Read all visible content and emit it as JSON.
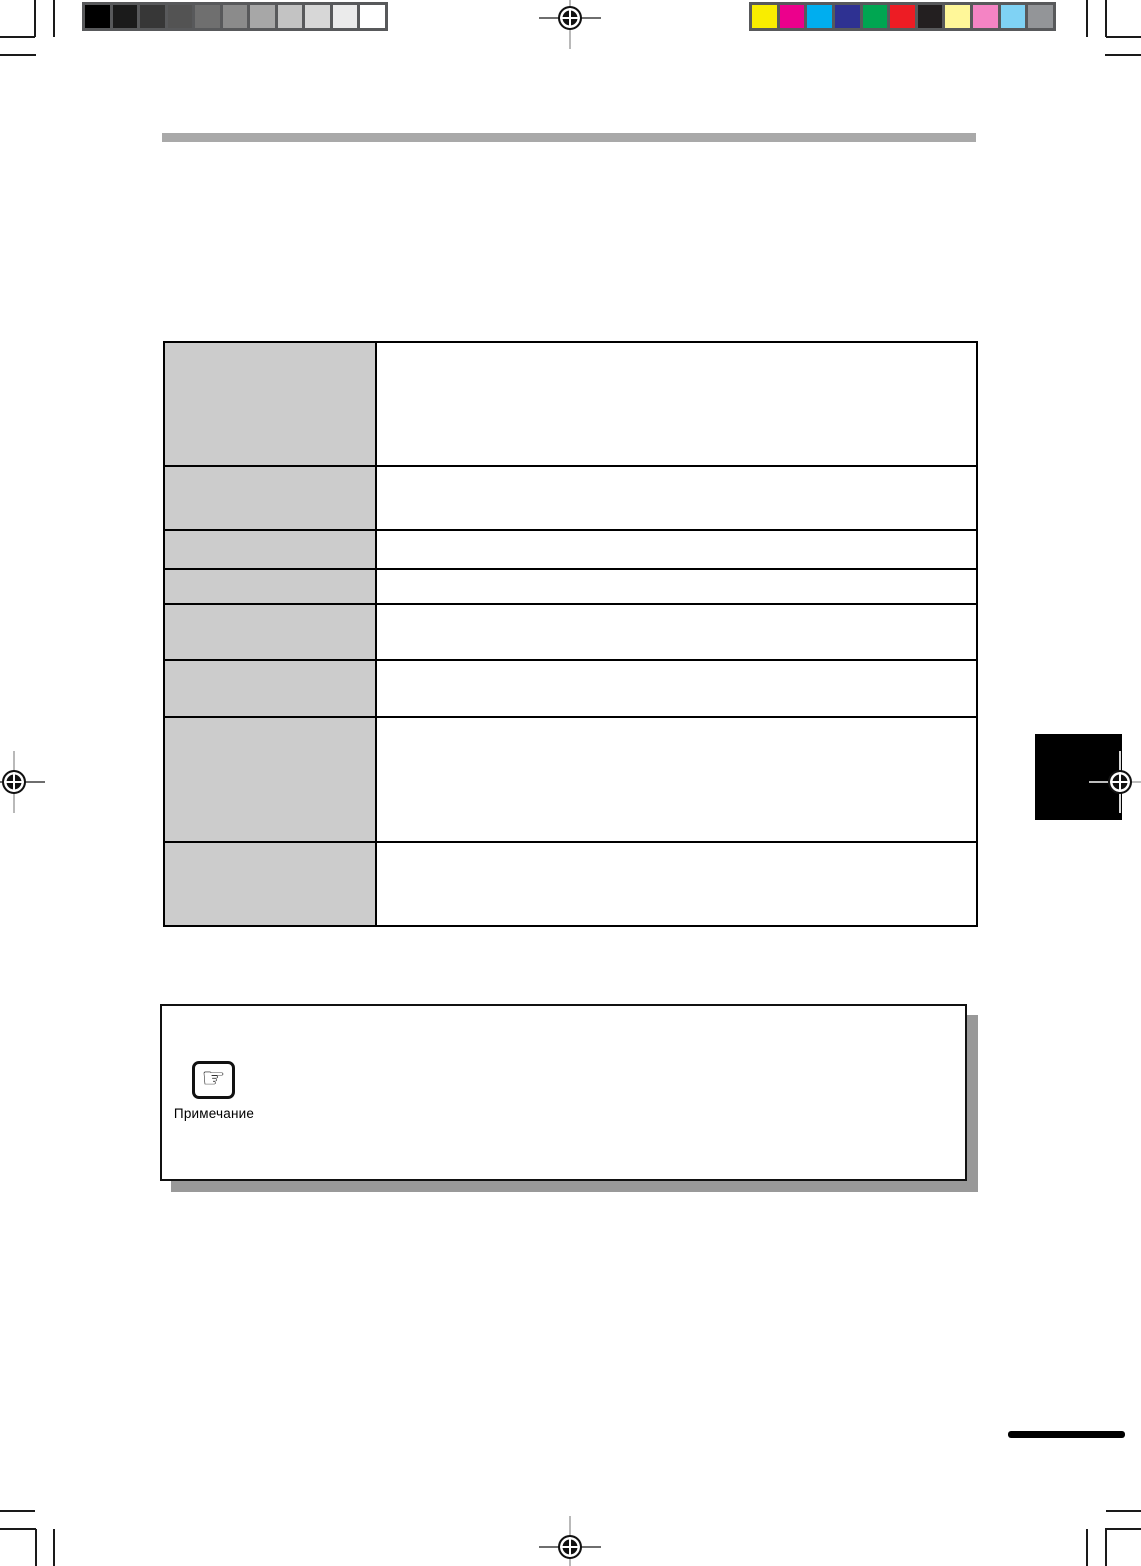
{
  "note": {
    "label": "Примечание",
    "icon_glyph": "☞"
  },
  "calibration": {
    "frame_color": "#58595b",
    "grayscale_steps": [
      "#000000",
      "#1b1b1b",
      "#373737",
      "#535353",
      "#6f6f6f",
      "#8b8b8b",
      "#a7a7a7",
      "#c3c3c3",
      "#d7d7d7",
      "#ebebeb",
      "#ffffff"
    ],
    "color_steps": [
      "#f9ed00",
      "#ec008c",
      "#00aeef",
      "#2e3192",
      "#00a651",
      "#ed1c24",
      "#231f20",
      "#fff799",
      "#f484c4",
      "#7fd2f4",
      "#939598"
    ]
  },
  "table": {
    "label_bg": "#cccccc",
    "rows": [
      {
        "label": "",
        "content": ""
      },
      {
        "label": "",
        "content": ""
      },
      {
        "label": "",
        "content": ""
      },
      {
        "label": "",
        "content": ""
      },
      {
        "label": "",
        "content": ""
      },
      {
        "label": "",
        "content": ""
      },
      {
        "label": "",
        "content": ""
      },
      {
        "label": "",
        "content": ""
      }
    ]
  },
  "accents": {
    "header_rule": "#a9a9a9",
    "note_shadow": "#999999",
    "side_tab": "#000000"
  }
}
